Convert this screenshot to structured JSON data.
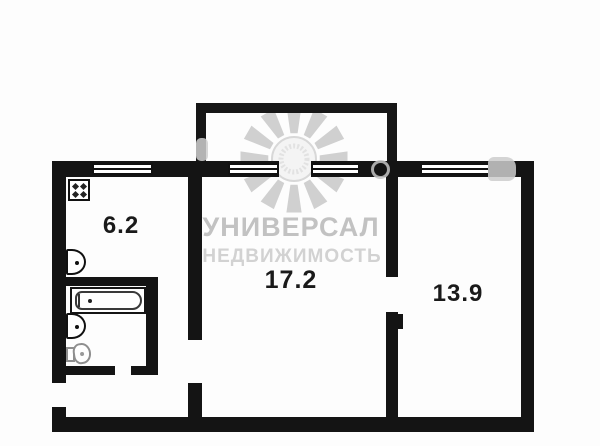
{
  "plan": {
    "type": "apartment-floor-plan",
    "rooms": [
      {
        "id": "kitchen",
        "area_label": "6.2"
      },
      {
        "id": "living-room",
        "area_label": "17.2"
      },
      {
        "id": "bedroom",
        "area_label": "13.9"
      }
    ],
    "fixtures": [
      "stove",
      "kitchen-sink",
      "bathtub",
      "bathroom-sink",
      "toilet"
    ],
    "features": [
      "balcony",
      "entrance-door-gap",
      "interior-door-gaps",
      "windows"
    ],
    "watermark": {
      "line1": "УНИВЕРСАЛ",
      "line2": "НЕДВИЖИМОСТЬ",
      "logo": "sunburst-logo"
    },
    "colors": {
      "wall": "#141414",
      "background": "#fdfdfd",
      "label_text": "#1a1a1a",
      "watermark_ray": "#d0d0d0",
      "watermark_text1": "#c2c2c2",
      "watermark_text2": "#d2d2d2"
    }
  }
}
